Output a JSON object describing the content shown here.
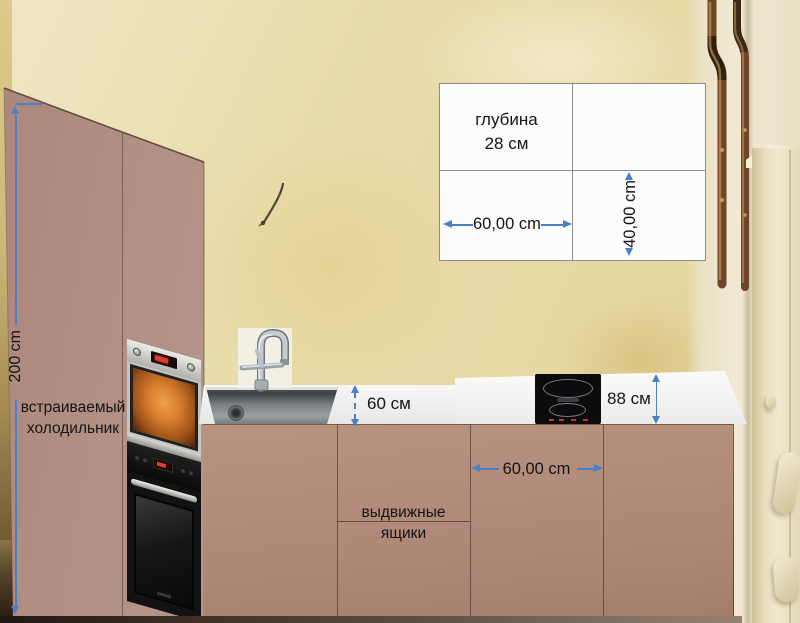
{
  "info_box": {
    "depth_line1": "глубина",
    "depth_line2": "28 см",
    "width_label": "60,00 cm",
    "height_label": "40,00 cm"
  },
  "annotations": {
    "tall_cabinet_height": "200 cm",
    "fridge_line1": "встраиваемый",
    "fridge_line2": "холодильник",
    "counter_depth": "60 см",
    "counter_height": "88 см",
    "base_cabinet_width": "60,00 cm",
    "drawers_line1": "выдвижные",
    "drawers_line2": "ящики"
  },
  "colors": {
    "accent_blue": "#4a80c8",
    "cabinet_mauve": "#b28e80",
    "countertop_white": "#f1f1f0",
    "wall_beige": "#e8dbab"
  }
}
